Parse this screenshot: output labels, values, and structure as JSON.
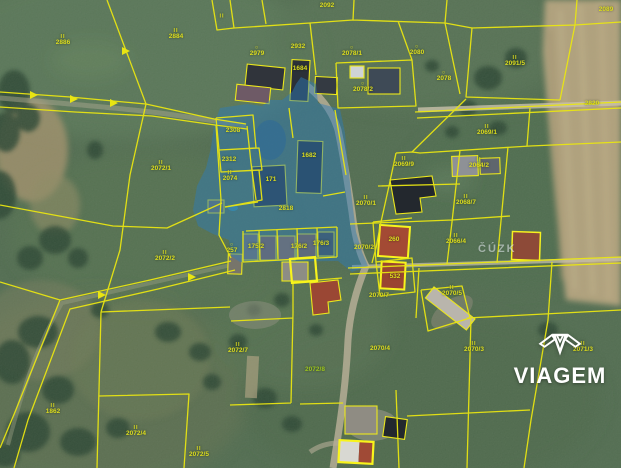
{
  "map": {
    "provider_watermark": "ČÚZK",
    "brand_watermark": "VIAGEM",
    "colors": {
      "parcel_line": "#e9e512",
      "highlight_line": "#f8f41c",
      "selection_fill": "#2e7cb8",
      "label_text": "#dcdc1e",
      "watermark_text": "#ebf0f5",
      "brand_text": "#ffffff"
    },
    "parcel_labels": [
      {
        "n": "2886",
        "s": "II",
        "x": 63,
        "y": 41
      },
      {
        "n": "2884",
        "s": "II",
        "x": 176,
        "y": 35
      },
      {
        "n": "",
        "s": "II",
        "x": 222,
        "y": 17
      },
      {
        "n": "2092",
        "s": "",
        "x": 327,
        "y": 6
      },
      {
        "n": "2089",
        "s": "",
        "x": 606,
        "y": 10
      },
      {
        "n": "2979",
        "s": "O",
        "x": 257,
        "y": 52
      },
      {
        "n": "2932",
        "s": "",
        "x": 298,
        "y": 47
      },
      {
        "n": "2078/1",
        "s": "O",
        "x": 352,
        "y": 52
      },
      {
        "n": "2080",
        "s": "O",
        "x": 417,
        "y": 51
      },
      {
        "n": "2078/2",
        "s": "O",
        "x": 363,
        "y": 88
      },
      {
        "n": "2078",
        "s": "O",
        "x": 444,
        "y": 77
      },
      {
        "n": "2091/5",
        "s": "II",
        "x": 515,
        "y": 62
      },
      {
        "n": "2820",
        "s": "",
        "x": 592,
        "y": 104
      },
      {
        "n": "2069/1",
        "s": "II",
        "x": 487,
        "y": 131
      },
      {
        "n": "2069/9",
        "s": "II",
        "x": 404,
        "y": 163
      },
      {
        "n": "2064/2",
        "s": "II",
        "x": 479,
        "y": 164
      },
      {
        "n": "2068/7",
        "s": "II",
        "x": 466,
        "y": 201
      },
      {
        "n": "2066/4",
        "s": "II",
        "x": 456,
        "y": 240
      },
      {
        "n": "2308",
        "s": "",
        "x": 233,
        "y": 131
      },
      {
        "n": "2312",
        "s": "",
        "x": 229,
        "y": 160
      },
      {
        "n": "1684",
        "s": "",
        "x": 300,
        "y": 69
      },
      {
        "n": "1682",
        "s": "",
        "x": 309,
        "y": 156
      },
      {
        "n": "171",
        "s": "",
        "x": 271,
        "y": 180
      },
      {
        "n": "2818",
        "s": "",
        "x": 286,
        "y": 209
      },
      {
        "n": "2070/1",
        "s": "II",
        "x": 366,
        "y": 202
      },
      {
        "n": "175/2",
        "s": "",
        "x": 256,
        "y": 247
      },
      {
        "n": "176/2",
        "s": "",
        "x": 299,
        "y": 247
      },
      {
        "n": "176/3",
        "s": "",
        "x": 321,
        "y": 244
      },
      {
        "n": "2070/2",
        "s": "",
        "x": 364,
        "y": 248
      },
      {
        "n": "260",
        "s": "",
        "x": 394,
        "y": 240
      },
      {
        "n": "532",
        "s": "",
        "x": 395,
        "y": 277
      },
      {
        "n": "2070/7",
        "s": "",
        "x": 379,
        "y": 296
      },
      {
        "n": "2070/5",
        "s": "II",
        "x": 452,
        "y": 292
      },
      {
        "n": "2072/1",
        "s": "II",
        "x": 161,
        "y": 167
      },
      {
        "n": "2074",
        "s": "II",
        "x": 230,
        "y": 177
      },
      {
        "n": "257",
        "s": "O",
        "x": 232,
        "y": 249
      },
      {
        "n": "2072/2",
        "s": "II",
        "x": 165,
        "y": 257
      },
      {
        "n": "1862",
        "s": "II",
        "x": 53,
        "y": 410
      },
      {
        "n": "2072/4",
        "s": "II",
        "x": 136,
        "y": 432
      },
      {
        "n": "2072/5",
        "s": "II",
        "x": 199,
        "y": 453
      },
      {
        "n": "2072/7",
        "s": "II",
        "x": 238,
        "y": 349
      },
      {
        "n": "2072/8",
        "s": "",
        "x": 315,
        "y": 370,
        "c": "#9cc41e"
      },
      {
        "n": "2070/4",
        "s": "",
        "x": 380,
        "y": 349
      },
      {
        "n": "2070/3",
        "s": "II",
        "x": 474,
        "y": 348
      },
      {
        "n": "2071/3",
        "s": "II",
        "x": 583,
        "y": 348
      }
    ]
  }
}
